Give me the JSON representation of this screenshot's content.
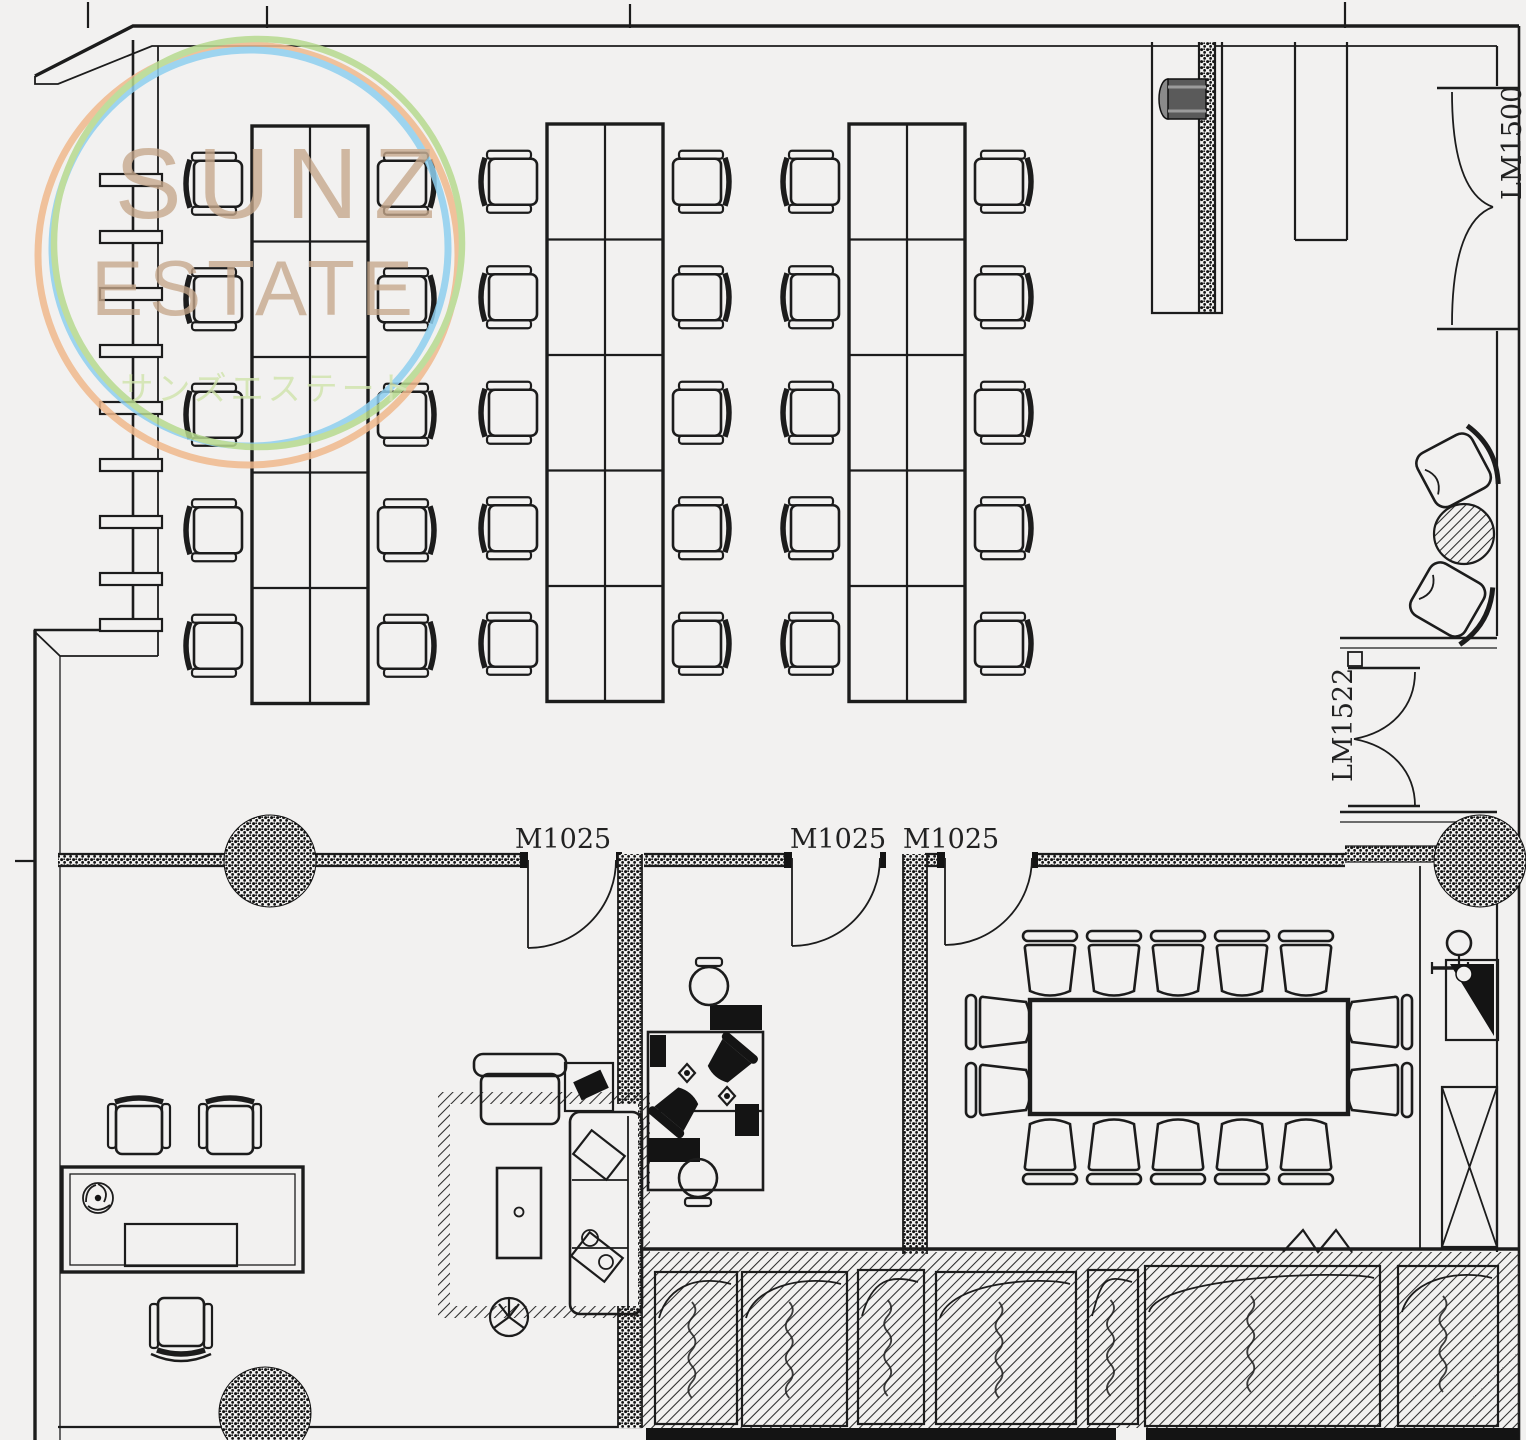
{
  "watermark": {
    "brand_top": "SUNZ",
    "brand_bottom": "ESTATE",
    "brand_jp": "サンズエステート",
    "ring_colors": [
      "#f0b98d",
      "#8fcfef",
      "#b7da8f"
    ],
    "text_color": "#c6a88b",
    "jp_text_color": "#cfe3ab"
  },
  "labels": {
    "door_interior_1": "M1025",
    "door_interior_2": "M1025",
    "door_interior_3": "M1025",
    "door_right": "LM1522",
    "door_top_right": "LM1500"
  },
  "colors": {
    "background": "#f2f1f0",
    "line": "#1c1c1c",
    "hatch": "#2a2a2a",
    "fill_dark": "#141414"
  },
  "furniture": {
    "workstation_clusters": [
      {
        "x": 252,
        "y": 126,
        "cols": 2,
        "rows": 5,
        "cell_w": 58,
        "cell_h": 115.5
      },
      {
        "x": 547,
        "y": 124,
        "cols": 2,
        "rows": 5,
        "cell_w": 58,
        "cell_h": 115.5
      },
      {
        "x": 849,
        "y": 124,
        "cols": 2,
        "rows": 5,
        "cell_w": 58,
        "cell_h": 115.5
      }
    ],
    "workstation_seats": 30,
    "conference": {
      "table": {
        "x": 1030,
        "y": 1000,
        "w": 318,
        "h": 114
      },
      "chairs_top": 5,
      "chairs_bottom": 5,
      "chairs_left": 2,
      "chairs_right": 2
    }
  },
  "hatch_zone": {
    "panels": [
      [
        655,
        1272,
        82,
        152
      ],
      [
        742,
        1272,
        105,
        154
      ],
      [
        858,
        1270,
        66,
        154
      ],
      [
        936,
        1272,
        140,
        152
      ],
      [
        1088,
        1270,
        50,
        154
      ],
      [
        1145,
        1266,
        235,
        160
      ],
      [
        1398,
        1266,
        100,
        160
      ]
    ]
  }
}
